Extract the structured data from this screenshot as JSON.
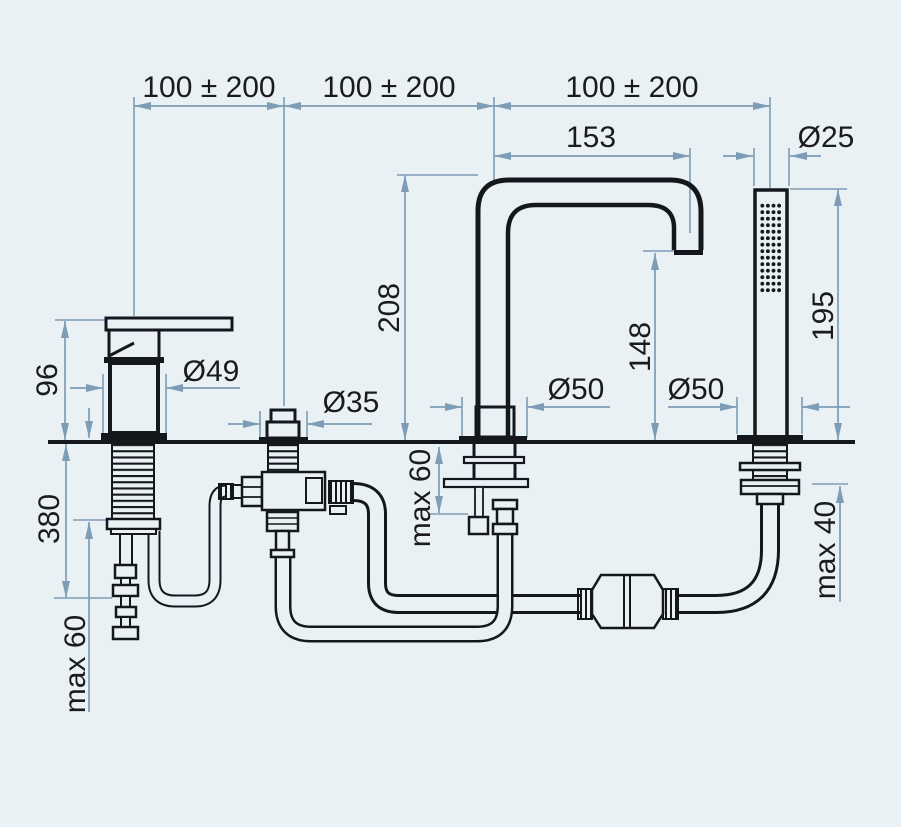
{
  "drawing": {
    "description": "Technical installation dimension drawing of a 4-hole deck-mounted bathtub mixer set: single-lever mixer, diverter, high spout, handshower, below-deck hoses and inline connector",
    "colors": {
      "background": "#e9f1f5",
      "product_line": "#14181d",
      "dimension_line": "#7d9cb6",
      "dimension_text": "#1b1b1b"
    },
    "labels": {
      "spacing_1": "100 ± 200",
      "spacing_2": "100 ± 200",
      "spacing_3": "100 ± 200",
      "spout_reach": "153",
      "handshower_diameter": "Ø25",
      "spout_height": "208",
      "spout_outlet_height": "148",
      "handshower_height": "195",
      "mixer_height": "96",
      "mixer_diameter": "Ø49",
      "diverter_diameter": "Ø35",
      "spout_hole_diameter": "Ø50",
      "handshower_hole_diameter": "Ø50",
      "under_deck_length": "380",
      "max_deck_thickness_mixer": "max 60",
      "max_deck_thickness_spout": "max 60",
      "max_deck_thickness_handshower": "max 40"
    }
  }
}
